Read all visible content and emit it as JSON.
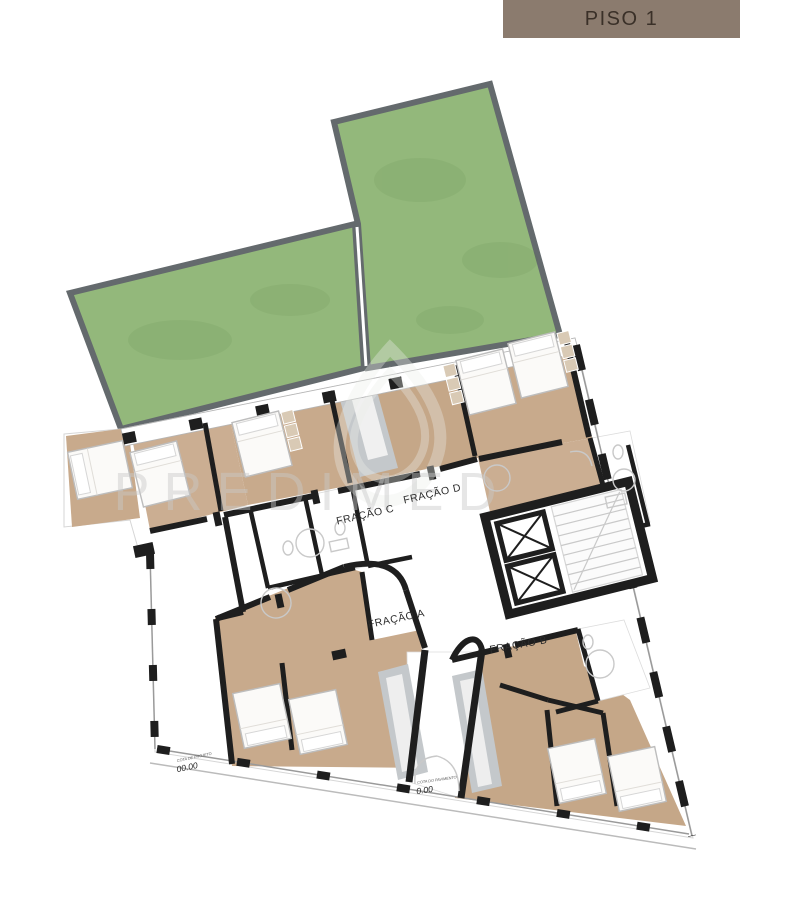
{
  "header": {
    "floor_label": "PISO 1"
  },
  "plan": {
    "fractions": [
      {
        "id": "A",
        "label": "FRAÇÃO A"
      },
      {
        "id": "B",
        "label": "FRAÇÃO B"
      },
      {
        "id": "C",
        "label": "FRAÇÃO C"
      },
      {
        "id": "D",
        "label": "FRAÇÃO D"
      }
    ],
    "elevations": [
      {
        "label": "COTA DE PROJETO",
        "value": "00.00"
      },
      {
        "label": "COTA DO PAVIMENTO",
        "value": "0.00"
      }
    ],
    "watermark": {
      "brand": "PREDIMED",
      "logo": "droplet-icon"
    }
  },
  "palette": {
    "banner_bg": "#8b7b6e",
    "banner_text": "#3a3028",
    "garden_green": "#93b87b",
    "garden_border": "#646a6d",
    "wood_floor": "#c8aa8c",
    "wall_black": "#1e1e1e",
    "tile_gray": "#c4c8cb",
    "watermark_gray": "#c9c9c9"
  }
}
